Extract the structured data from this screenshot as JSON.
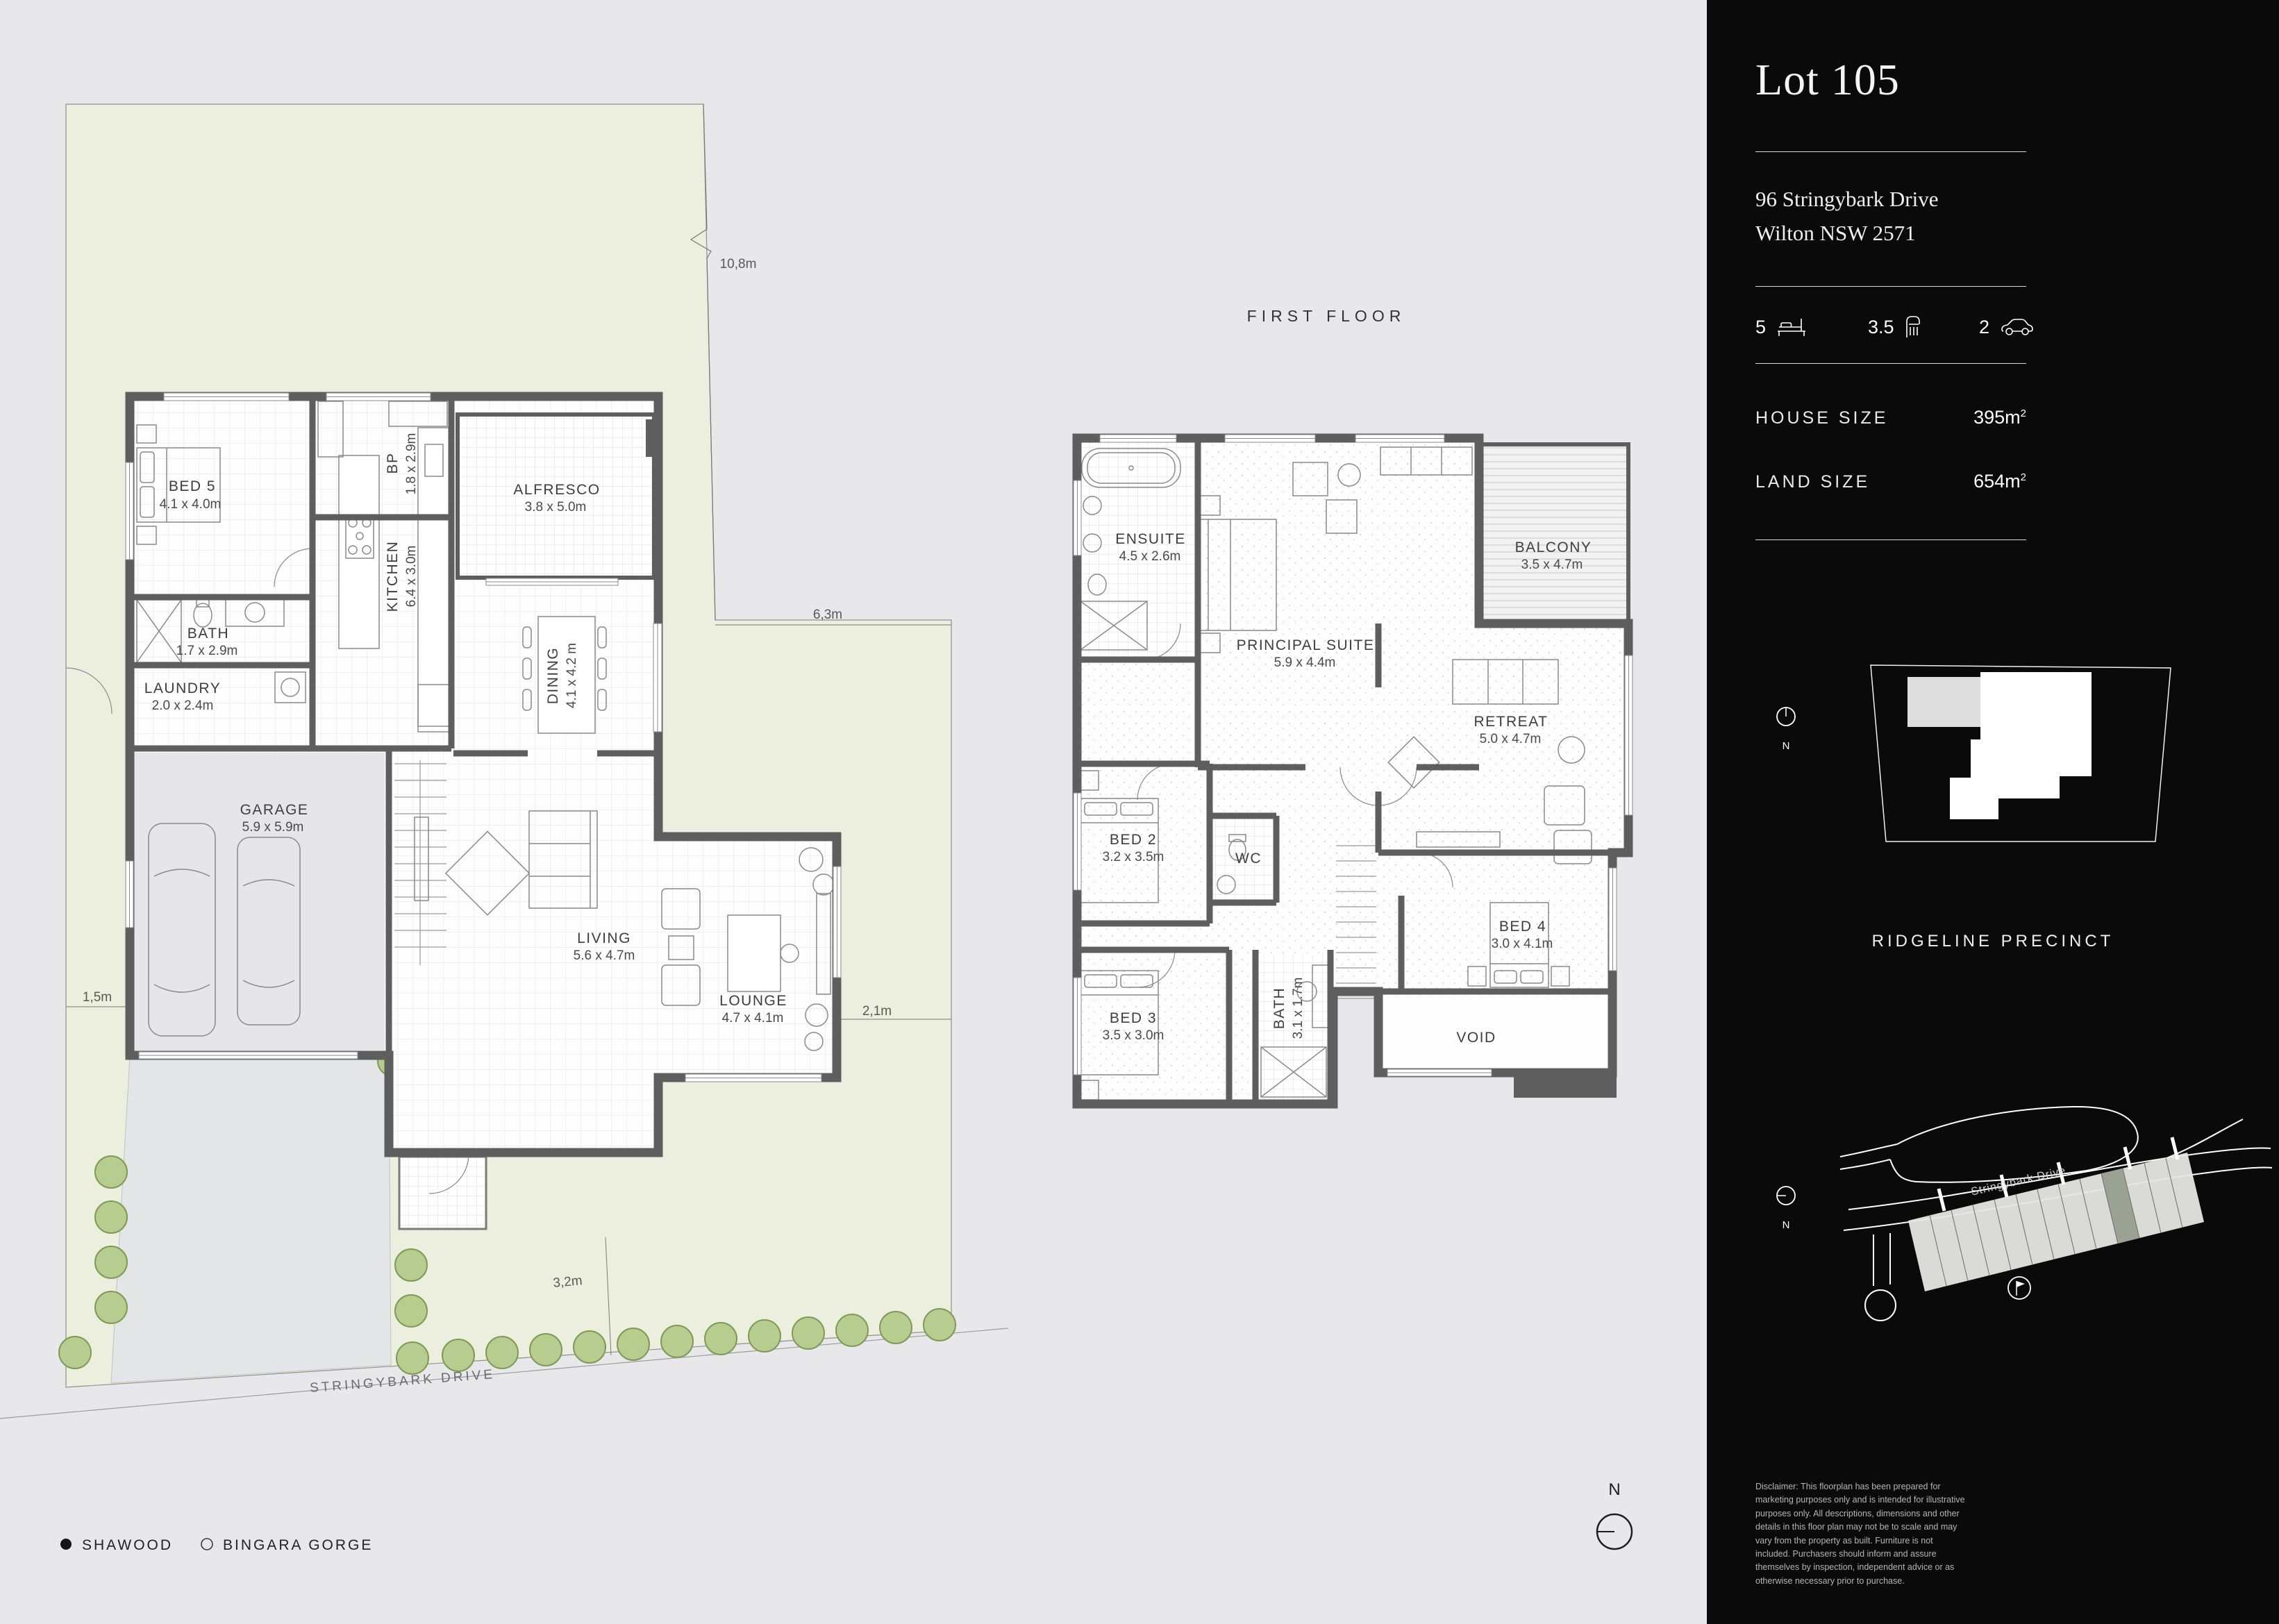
{
  "page": {
    "first_floor_title": "FIRST FLOOR",
    "legend": {
      "item1": "SHAWOOD",
      "item2": "BINGARA GORGE"
    },
    "compass_n": "N"
  },
  "site": {
    "street_name": "STRINGYBARK DRIVE",
    "dim_top": "10,8m",
    "dim_right": "6,3m",
    "dim_left": "1,5m",
    "dim_lounge": "2,1m",
    "dim_drive": "3,2m"
  },
  "ground_floor": {
    "rooms": [
      {
        "name": "BED 5",
        "dims": "4.1 x 4.0m"
      },
      {
        "name": "BATH",
        "dims": "1.7 x 2.9m"
      },
      {
        "name": "LAUNDRY",
        "dims": "2.0 x 2.4m"
      },
      {
        "name": "BP",
        "dims": "1.8 x 2.9m"
      },
      {
        "name": "KITCHEN",
        "dims": "6.4 x 3.0m"
      },
      {
        "name": "ALFRESCO",
        "dims": "3.8 x 5.0m"
      },
      {
        "name": "DINING",
        "dims": "4.1 x 4.2 m"
      },
      {
        "name": "GARAGE",
        "dims": "5.9 x 5.9m"
      },
      {
        "name": "LIVING",
        "dims": "5.6 x 4.7m"
      },
      {
        "name": "LOUNGE",
        "dims": "4.7 x 4.1m"
      }
    ]
  },
  "first_floor": {
    "rooms": [
      {
        "name": "ENSUITE",
        "dims": "4.5 x 2.6m"
      },
      {
        "name": "PRINCIPAL SUITE",
        "dims": "5.9 x 4.4m"
      },
      {
        "name": "BALCONY",
        "dims": "3.5 x 4.7m"
      },
      {
        "name": "RETREAT",
        "dims": "5.0 x 4.7m"
      },
      {
        "name": "BED 2",
        "dims": "3.2 x 3.5m"
      },
      {
        "name": "WC",
        "dims": ""
      },
      {
        "name": "BED 3",
        "dims": "3.5 x 3.0m"
      },
      {
        "name": "BATH",
        "dims": "3.1 x 1.7m"
      },
      {
        "name": "BED 4",
        "dims": "3.0 x 4.1m"
      },
      {
        "name": "VOID",
        "dims": ""
      }
    ]
  },
  "sidebar": {
    "lot_title": "Lot 105",
    "address_line1": "96 Stringybark Drive",
    "address_line2": "Wilton NSW 2571",
    "stats": {
      "beds": "5",
      "baths": "3.5",
      "cars": "2"
    },
    "house_size_label": "HOUSE SIZE",
    "house_size_value": "395m",
    "house_size_sup": "2",
    "land_size_label": "LAND SIZE",
    "land_size_value": "654m",
    "land_size_sup": "2",
    "precinct_title": "RIDGELINE PRECINCT",
    "map_street_label": "Stringybark Drive",
    "north_label": "N",
    "disclaimer": "Disclaimer: This floorplan has been prepared for marketing purposes only and is intended for illustrative purposes only. All descriptions, dimensions and other details in this floor plan may not be to scale and may vary from the property as built. Furniture is not included. Purchasers should inform and assure themselves by inspection, independent advice or as otherwise necessary prior to purchase."
  },
  "colors": {
    "sidebar_bg": "#0a0a0a",
    "canvas_bg": "#e8e8ea",
    "site_fill": "#edefde",
    "wall": "#5e5e5e",
    "tree_fill": "#b7cc8f",
    "tree_stroke": "#7d9a58",
    "highlight_lot": "#9aa294"
  }
}
